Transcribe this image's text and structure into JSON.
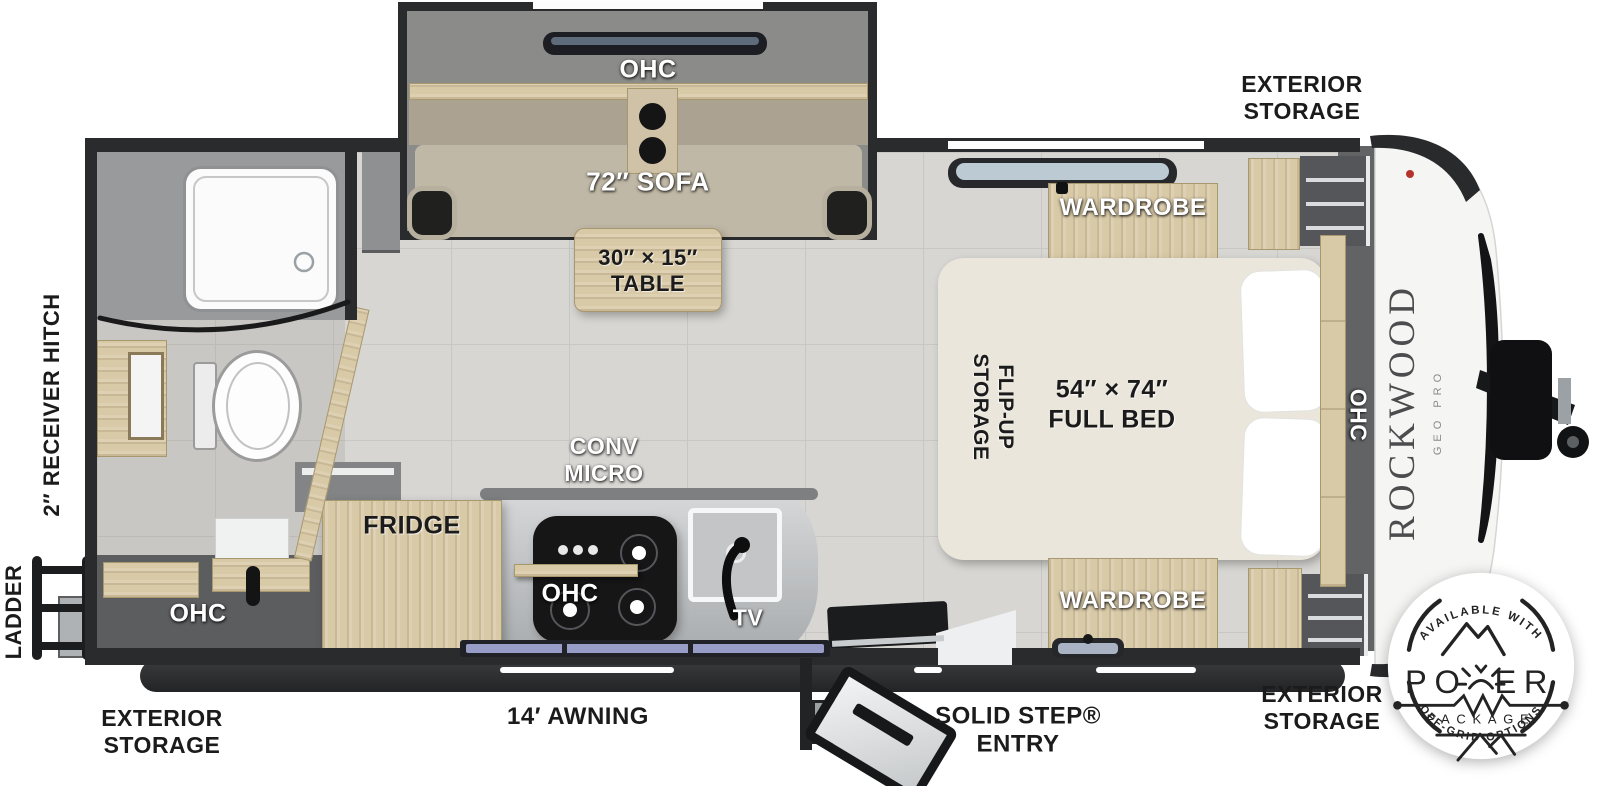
{
  "colors": {
    "wall": "#2a2b2d",
    "floor_tile": "#d7d6d3",
    "cabinet_wood": "#d8c9a7",
    "window_glass": "#9aa0cc",
    "badge_ink": "#232323",
    "brand_gray": "#4c4c4e"
  },
  "exterior": {
    "storage_line1": "EXTERIOR",
    "storage_line2": "STORAGE",
    "awning": "14′ AWNING",
    "entry_line1": "SOLID STEP®",
    "entry_line2": "ENTRY",
    "receiver_hitch": "2″ RECEIVER HITCH",
    "ladder": "LADDER"
  },
  "living_area": {
    "ohc": "OHC",
    "sofa": "72″ SOFA",
    "table_line1": "30″ × 15″",
    "table_line2": "TABLE"
  },
  "kitchen": {
    "conv_line1": "CONV",
    "conv_line2": "MICRO",
    "ohc": "OHC",
    "fridge": "FRIDGE",
    "tv": "TV"
  },
  "bathroom": {
    "ohc": "OHC"
  },
  "bedroom": {
    "flip_line1": "FLIP-UP",
    "flip_line2": "STORAGE",
    "bed_line1": "54″ × 74″",
    "bed_line2": "FULL BED",
    "ohc": "OHC",
    "wardrobe": "WARDROBE"
  },
  "brand": {
    "name": "ROCKWOOD",
    "model": "GEO PRO"
  },
  "badge": {
    "top": "AVAILABLE WITH",
    "power_left": "PO",
    "power_right": "ER",
    "package": "PACKAGE",
    "bottom": "OFF-GRID OPTIONS"
  }
}
